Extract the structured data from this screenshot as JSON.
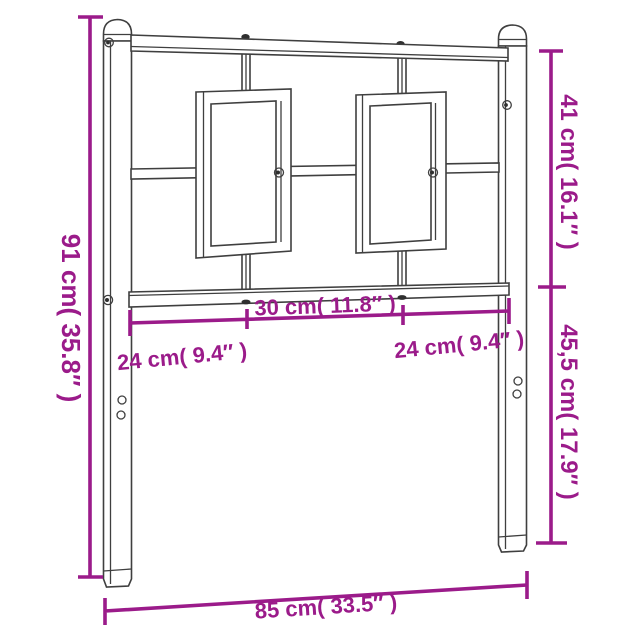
{
  "diagram": {
    "subject": "metal-headboard-dimension-diagram",
    "background_color": "#ffffff",
    "outline_color": "#3f3f3f",
    "accent_color": "#9b1b8a",
    "dimensions": {
      "total_height": "91 cm( 35.8″ )",
      "upper_section_height": "41 cm( 16.1″ )",
      "lower_section_height": "45,5 cm( 17.9″ )",
      "center_strut_spacing": "30 cm( 11.8″ )",
      "left_strut_spacing": "24 cm( 9.4″ )",
      "right_strut_spacing": "24 cm( 9.4″ )",
      "total_width": "85 cm( 33.5″ )"
    }
  }
}
